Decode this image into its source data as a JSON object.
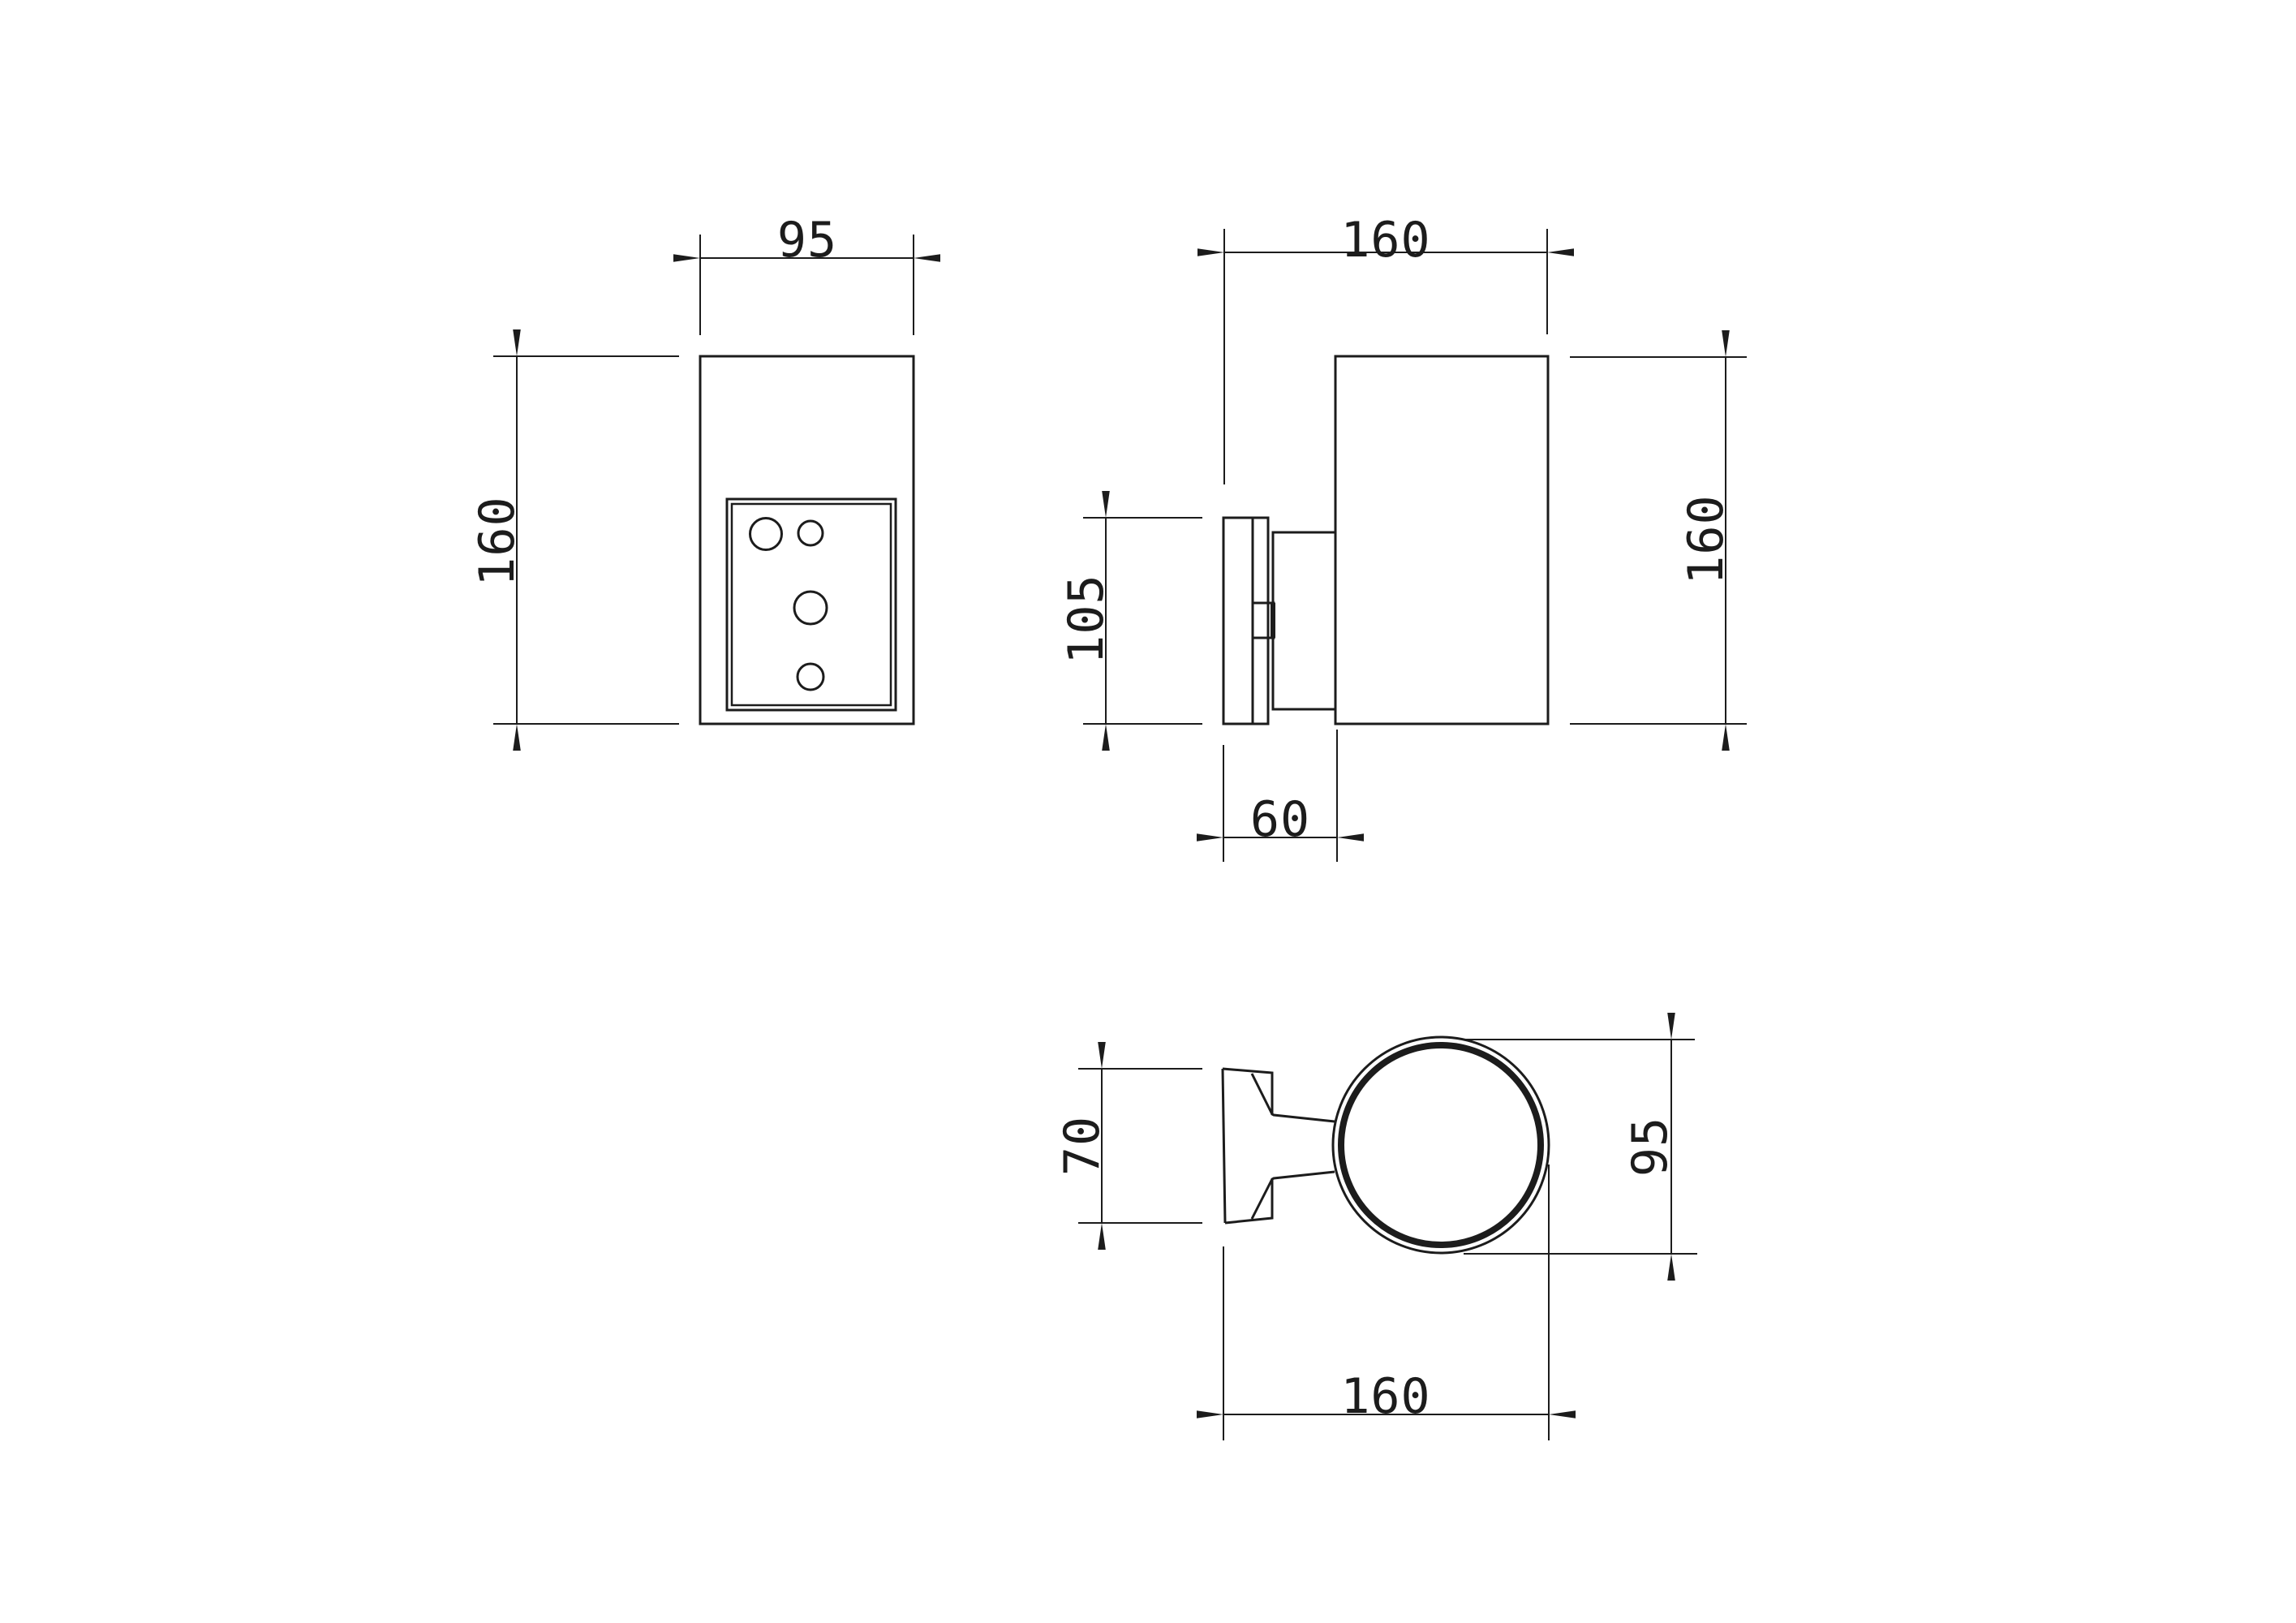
{
  "drawing": {
    "type": "technical-orthographic-dimension-drawing",
    "colors": {
      "background": "#ffffff",
      "line": "#1c1c1c"
    },
    "views": {
      "front": {
        "width_label": "95",
        "height_label": "160"
      },
      "side": {
        "depth_label": "160",
        "plate_height_label": "105",
        "height_label": "160",
        "bracket_depth_label": "60"
      },
      "top": {
        "plate_width_label": "70",
        "diameter_label": "95",
        "depth_label": "160"
      }
    }
  }
}
